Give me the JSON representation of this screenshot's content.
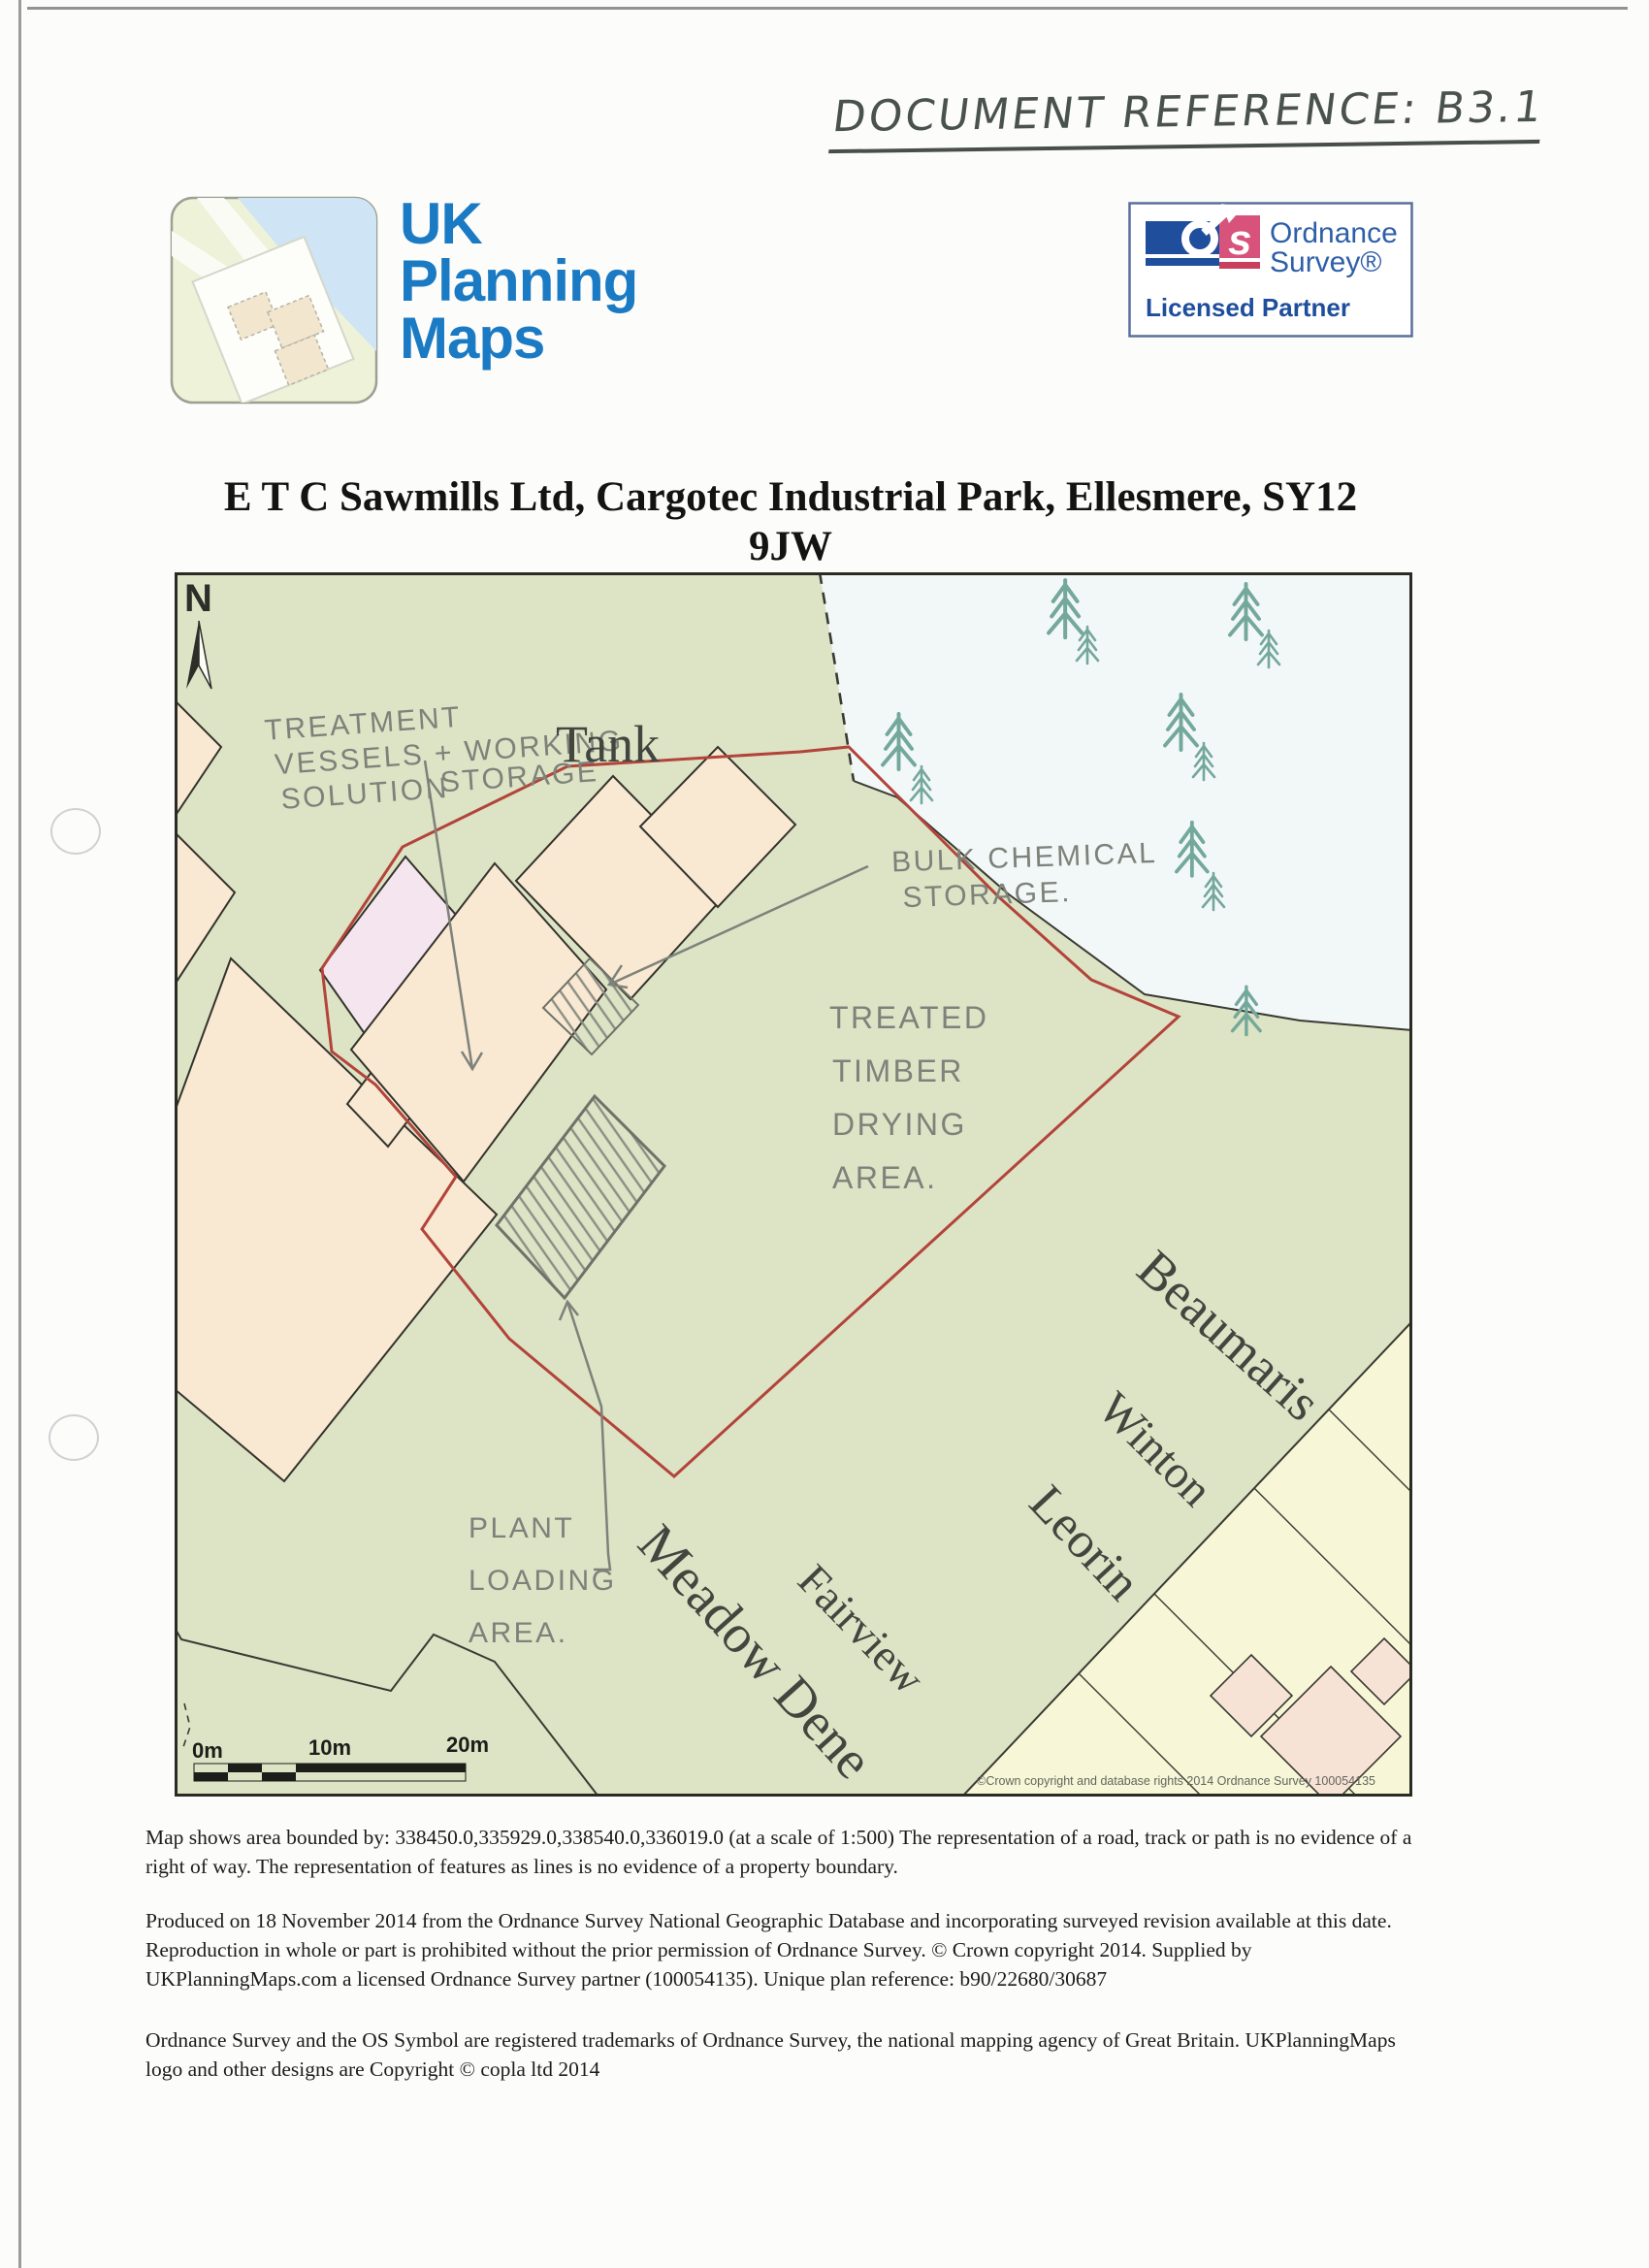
{
  "document": {
    "reference": "DOCUMENT REFERENCE: B3.1",
    "title_line1": "E T C Sawmills Ltd, Cargotec Industrial Park, Ellesmere, SY12",
    "title_line2": "9JW"
  },
  "logo": {
    "word1": "UK",
    "word2": "Planning",
    "word3": "Maps",
    "brand_color": "#1b7ac4"
  },
  "os_badge": {
    "o": "o",
    "s": "s",
    "name_line1": "Ordnance",
    "name_line2": "Survey®",
    "partner": "Licensed Partner",
    "blue": "#1e4e9c",
    "pink": "#d8537b"
  },
  "map": {
    "north": "N",
    "tank_label": "Tank",
    "streets": [
      "Beaumaris",
      "Winton",
      "Leorin",
      "Fairview",
      "Meadow Dene"
    ],
    "annotations": {
      "treatment_line1": "TREATMENT",
      "treatment_line2": "VESSELS + WORKING",
      "treatment_line3a": "SOLUTION",
      "treatment_line3b": "STORAGE",
      "bulk_line1": "BULK CHEMICAL",
      "bulk_line2": "STORAGE.",
      "treated_line1": "TREATED",
      "treated_line2": "TIMBER",
      "treated_line3": "DRYING",
      "treated_line4": "AREA.",
      "plant_line1": "PLANT",
      "plant_line2": "LOADING",
      "plant_line3": "AREA."
    },
    "scale": {
      "tick0": "0m",
      "tick1": "10m",
      "tick2": "20m"
    },
    "copyright": "©Crown copyright and database rights 2014 Ordnance Survey 100054135",
    "colors": {
      "green": "#dde3c5",
      "pale_blue": "#f2f7f8",
      "building": "#f9e8d2",
      "pink_building": "#f4e5ef",
      "cream": "#f7f7d8",
      "peach": "#f6e3d6",
      "site_boundary": "#b2443a",
      "tree": "#74a89a",
      "pencil": "#7d827a"
    }
  },
  "footer": {
    "para1": "Map shows area bounded by: 338450.0,335929.0,338540.0,336019.0 (at a scale of 1:500) The representation of a road, track or path is no evidence of a right of way. The representation of features as lines is no evidence of a property boundary.",
    "para2": "Produced on 18 November 2014 from the Ordnance Survey National Geographic Database and incorporating surveyed revision available at this date. Reproduction in whole or part is prohibited without the prior permission of Ordnance Survey. © Crown copyright 2014. Supplied by UKPlanningMaps.com a licensed Ordnance Survey partner (100054135). Unique plan reference: b90/22680/30687",
    "para3": "Ordnance Survey and the OS Symbol are registered trademarks of Ordnance Survey, the national mapping agency of Great Britain. UKPlanningMaps logo and other designs are Copyright © copla ltd 2014"
  }
}
